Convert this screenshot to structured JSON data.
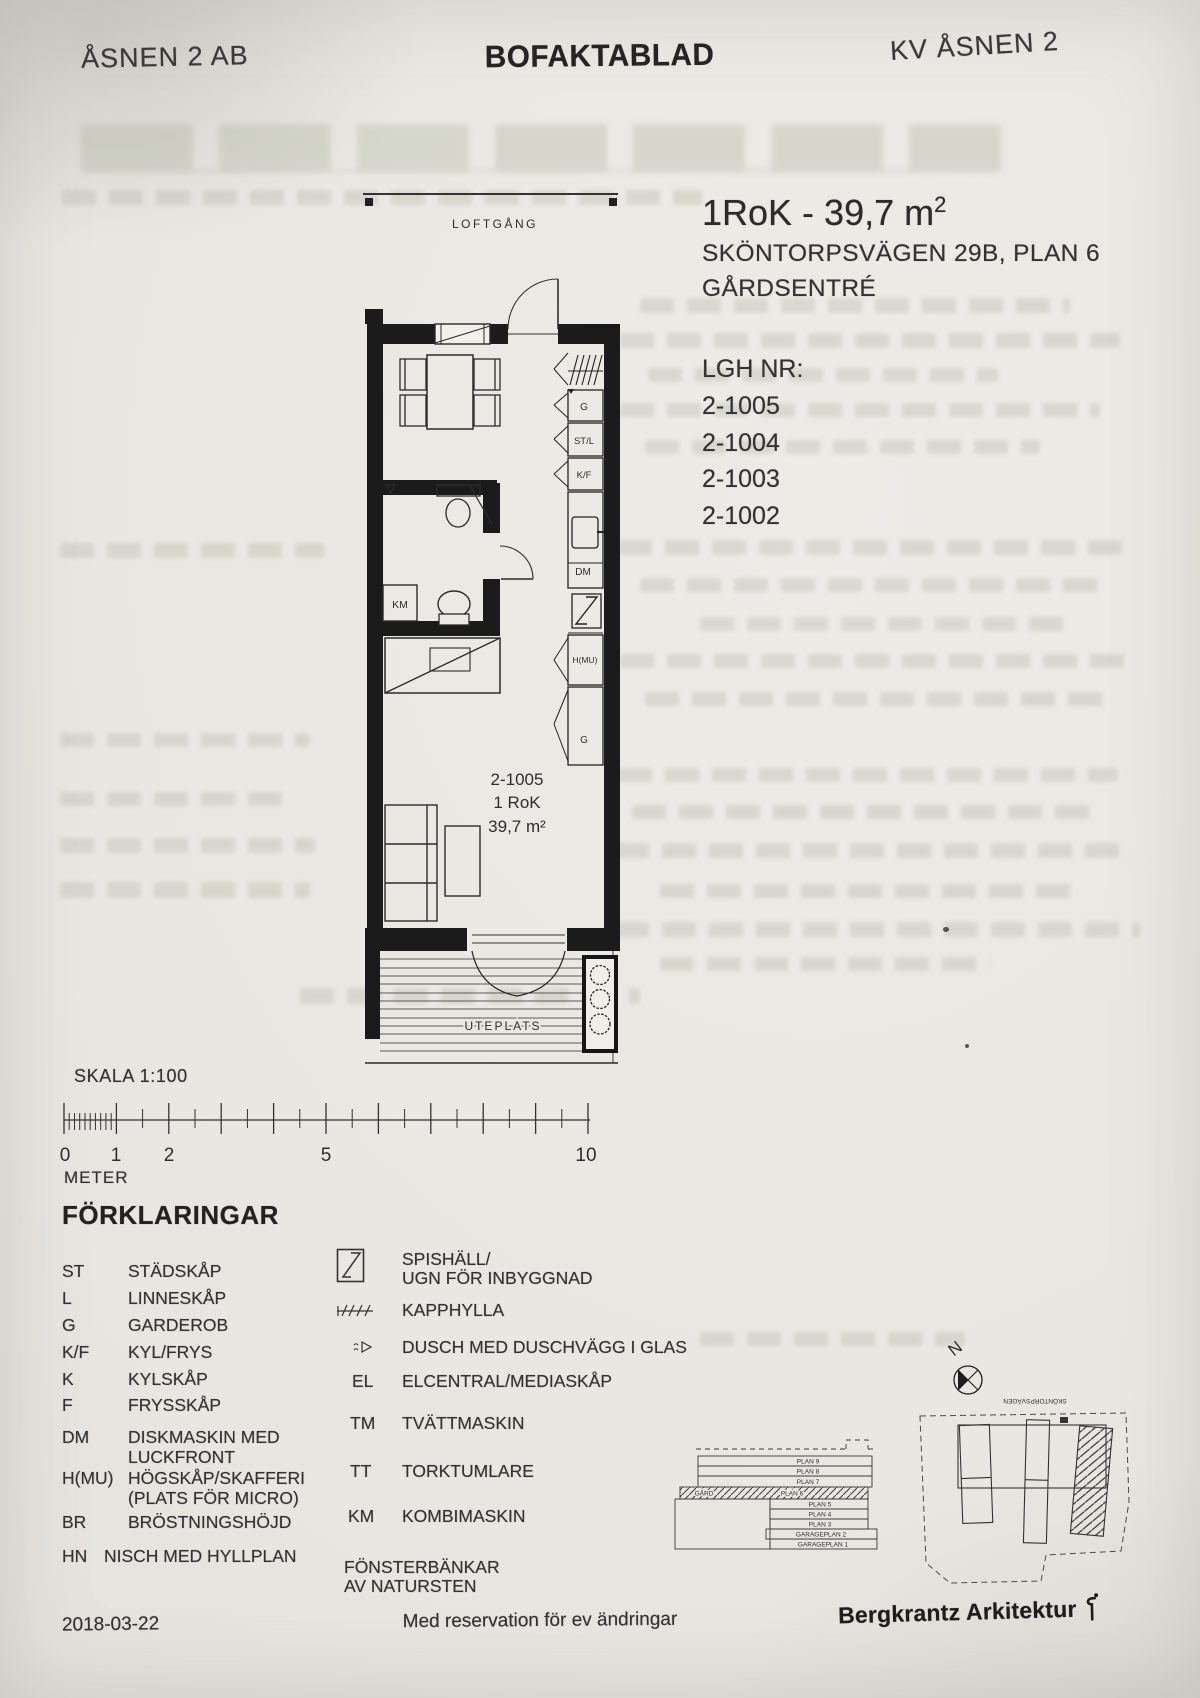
{
  "header": {
    "left": "ÅSNEN 2 AB",
    "center": "BOFAKTABLAD",
    "right": "KV ÅSNEN 2"
  },
  "apartment": {
    "title": "1RoK - 39,7 m",
    "area_sup": "2",
    "address": "SKÖNTORPSVÄGEN 29B, PLAN 6",
    "entrance": "GÅRDSENTRÉ",
    "lgh_label": "LGH NR:",
    "lgh_numbers": [
      "2-1005",
      "2-1004",
      "2-1003",
      "2-1002"
    ]
  },
  "plan": {
    "loftgang": "LOFTGÅNG",
    "window_label": "BR 780",
    "labels": {
      "g1": "G",
      "stl": "ST/L",
      "kf": "K/F",
      "dm": "DM",
      "hmu": "H(MU)",
      "g2": "G",
      "km": "KM"
    },
    "unit": {
      "number": "2-1005",
      "type": "1 RoK",
      "area": "39,7 m²"
    },
    "uteplats": "UTEPLATS"
  },
  "scale": {
    "label": "SKALA 1:100",
    "unit": "METER",
    "n0": "0",
    "n1": "1",
    "n2": "2",
    "n5": "5",
    "n10": "10"
  },
  "legend": {
    "title": "FÖRKLARINGAR",
    "left": [
      {
        "abbr": "ST",
        "label": "STÄDSKÅP"
      },
      {
        "abbr": "L",
        "label": "LINNESKÅP"
      },
      {
        "abbr": "G",
        "label": "GARDEROB"
      },
      {
        "abbr": "K/F",
        "label": "KYL/FRYS"
      },
      {
        "abbr": "K",
        "label": "KYLSKÅP"
      },
      {
        "abbr": "F",
        "label": "FRYSSKÅP"
      },
      {
        "abbr": "DM",
        "label": "DISKMASKIN MED",
        "label2": "LUCKFRONT"
      },
      {
        "abbr": "H(MU)",
        "label": "HÖGSKÅP/SKAFFERI",
        "label2": "(PLATS FÖR MICRO)"
      },
      {
        "abbr": "BR",
        "label": "BRÖSTNINGSHÖJD"
      },
      {
        "abbr": "HN",
        "label": "NISCH MED HYLLPLAN"
      }
    ],
    "right": [
      {
        "label": "SPISHÄLL/",
        "label2": "UGN FÖR INBYGGNAD"
      },
      {
        "label": "KAPPHYLLA"
      },
      {
        "label": "DUSCH MED DUSCHVÄGG I GLAS"
      },
      {
        "abbr": "EL",
        "label": "ELCENTRAL/MEDIASKÅP"
      },
      {
        "abbr": "TM",
        "label": "TVÄTTMASKIN"
      },
      {
        "abbr": "TT",
        "label": "TORKTUMLARE"
      },
      {
        "abbr": "KM",
        "label": "KOMBIMASKIN"
      },
      {
        "label": "FÖNSTERBÄNKAR",
        "label2": "AV NATURSTEN"
      }
    ]
  },
  "section": {
    "floors": [
      "PLAN 9",
      "PLAN 8",
      "PLAN 7",
      "PLAN 6",
      "PLAN 5",
      "PLAN 4",
      "PLAN 3",
      "GARAGEPLAN 2",
      "GARAGEPLAN 1"
    ],
    "yard": "GÅRD"
  },
  "siteplan": {
    "north": "N",
    "street": "SKÖNTORPSVÄGEN"
  },
  "footer": {
    "date": "2018-03-22",
    "note": "Med reservation för ev ändringar",
    "firm": "Bergkrantz Arkitektur"
  }
}
